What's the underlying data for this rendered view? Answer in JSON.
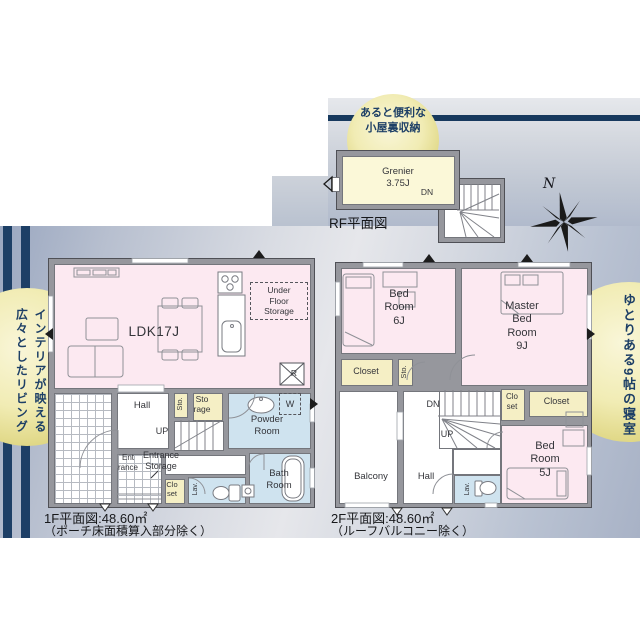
{
  "rf": {
    "bubble": "あると便利な\n小屋裏収納",
    "grenier": "Grenier\n3.75J",
    "dn": "DN",
    "caption": "RF平面図"
  },
  "compass": {
    "north": "N"
  },
  "f1": {
    "caption": "1F平面図:48.60㎡",
    "note": "（ポーチ床面積算入部分除く）",
    "bubble": "インテリアが映える\n広々としたリビング",
    "ldk": "LDK17J",
    "under_floor_storage": "Under\nFloor\nStorage",
    "fridge": "R",
    "hall": "Hall",
    "up": "UP",
    "sto": "Sto.",
    "storage": "Sto\nrage",
    "entrance": "Ent\nrance",
    "entrance_storage": "Entrance\nStorage",
    "closet": "Clo\nset",
    "lav": "Lav.",
    "powder": "Powder\nRoom",
    "washer": "W",
    "bath": "Bath\nRoom"
  },
  "f2": {
    "caption": "2F平面図:48.60㎡",
    "note": "（ルーフバルコニー除く）",
    "bubble": "ゆとりある9帖の寝室",
    "bed6": "Bed\nRoom\n6J",
    "master": "Master\nBed\nRoom\n9J",
    "bed5": "Bed\nRoom\n5J",
    "closet_left": "Closet",
    "sto": "Sto.",
    "balcony": "Balcony",
    "hall": "Hall",
    "dn": "DN",
    "up": "UP",
    "closet_small": "Clo\nset",
    "closet_right": "Closet",
    "lav": "Lav."
  },
  "colors": {
    "accent_navy": "#17395e",
    "panel_blue_gray": "#a9b4c9",
    "bubble_yellow": "#e8e094",
    "room_pink": "#fce9f1",
    "room_cream": "#f5efc5",
    "room_blue": "#cfe3ef",
    "grenier_cream": "#fbf8d8",
    "wall_gray": "#96979d"
  }
}
